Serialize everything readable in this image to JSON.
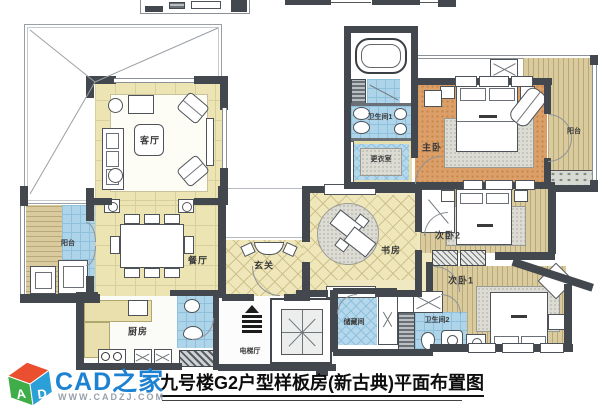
{
  "title": "九号楼G2户型样板房(新古典)平面布置图",
  "logo": {
    "brand": "CAD之家",
    "website": "WWW.CADZJ.COM",
    "cube_letters": {
      "left": "A",
      "right": "D"
    }
  },
  "rooms": {
    "living": "客厅",
    "dining": "餐厅",
    "kitchen": "厨房",
    "foyer": "玄关",
    "elevator_hall": "电梯厅",
    "study": "书房",
    "master_bedroom": "主卧",
    "bedroom2": "次卧2",
    "bedroom1": "次卧1",
    "bathroom1": "卫生间1",
    "bathroom2": "卫生间2",
    "dressing_room": "更衣室",
    "storage": "储藏间",
    "balcony_left": "阳台",
    "balcony_right": "阳台"
  },
  "colors": {
    "wall": "#42484e",
    "floor_cream": "#ece4b2",
    "floor_master_orange": "#dd9f68",
    "floor_wood": "#d9cb9e",
    "floor_tile_blue": "#aed4ea",
    "carpet_gray": "#dcdcd5",
    "brand_blue": "#1e82d2"
  }
}
